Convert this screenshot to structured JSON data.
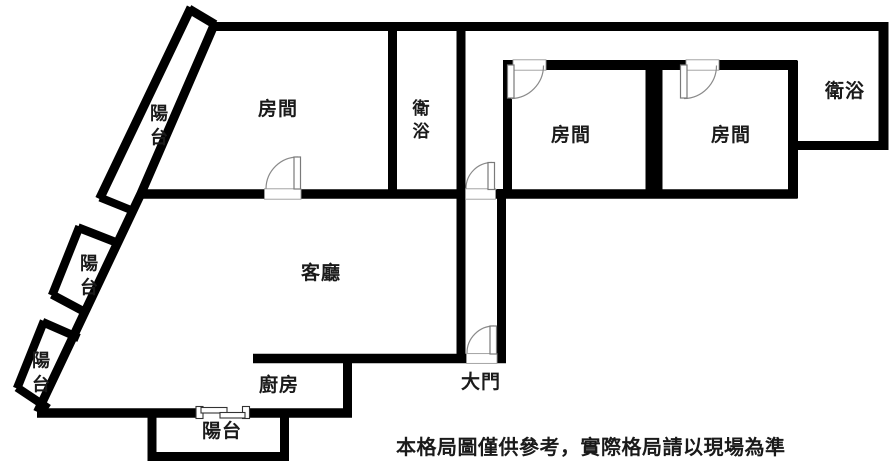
{
  "colors": {
    "wall": "#000000",
    "background": "#ffffff",
    "door_line": "#8a8a8a",
    "text": "#1a1a1a"
  },
  "rooms": [
    {
      "key": "balcony-top",
      "label": "陽台"
    },
    {
      "key": "bedroom-top-left",
      "label": "房間"
    },
    {
      "key": "bathroom-left",
      "label": "衛浴"
    },
    {
      "key": "bedroom-right-1",
      "label": "房間"
    },
    {
      "key": "bedroom-right-2",
      "label": "房間"
    },
    {
      "key": "bathroom-right",
      "label": "衛浴"
    },
    {
      "key": "balcony-middle",
      "label": "陽台"
    },
    {
      "key": "balcony-lower",
      "label": "陽台"
    },
    {
      "key": "living-room",
      "label": "客廳"
    },
    {
      "key": "kitchen",
      "label": "廚房"
    },
    {
      "key": "main-entrance",
      "label": "大門"
    },
    {
      "key": "balcony-bottom",
      "label": "陽台"
    }
  ],
  "disclaimer": "本格局圖僅供參考，實際格局請以現場為準"
}
